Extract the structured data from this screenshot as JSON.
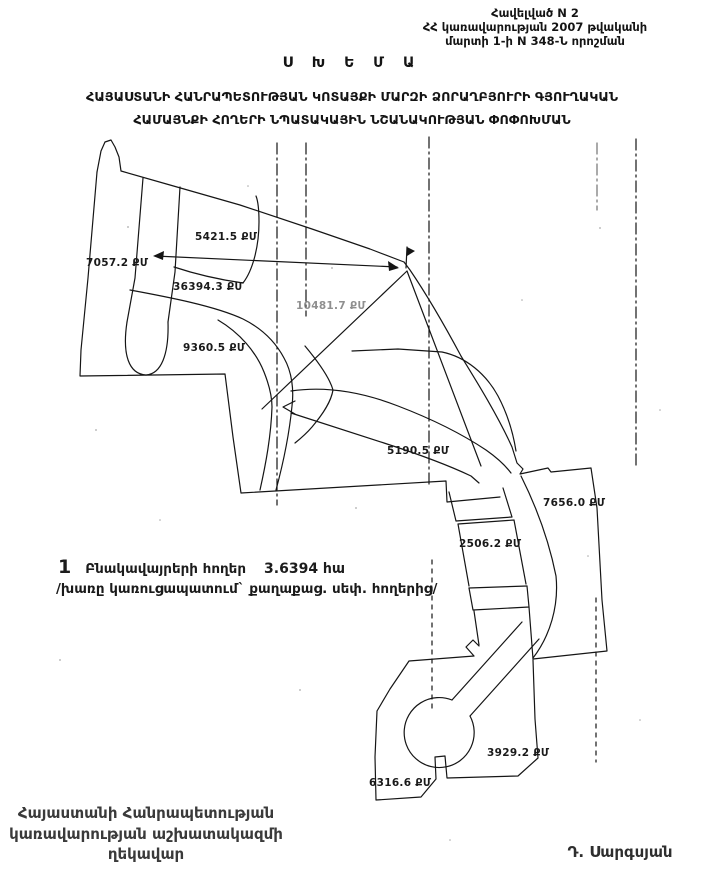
{
  "header": {
    "line1": "Հավելված N 2",
    "line2": "ՀՀ կառավարության 2007 թվականի",
    "line3": "մարտի 1-ի N 348-Ն որոշման"
  },
  "title": "Ս Խ Ե Մ Ա",
  "subtitle": {
    "line1": "ՀԱՅԱՍՏԱՆԻ ՀԱՆՐԱՊԵՏՈՒԹՅԱՆ ԿՈՏԱՅՔԻ ՄԱՐԶԻ ՁՈՐԱՂԲՅՈՒՐԻ ԳՅՈՒՂԱԿԱՆ",
    "line2": "ՀԱՄԱՅՆՔԻ ՀՈՂԵՐԻ ՆՊԱՏԱԿԱՅԻՆ ՆՇԱՆԱԿՈՒԹՅԱՆ ՓՈՓՈԽՄԱՆ"
  },
  "map": {
    "area_labels": [
      {
        "text": "5421.5 ՔՄ",
        "x": 195,
        "y": 231
      },
      {
        "text": "7057.2 ՔՄ",
        "x": 86,
        "y": 257
      },
      {
        "text": "36394.3 ՔՄ",
        "x": 173,
        "y": 281
      },
      {
        "text": "10481.7 ՔՄ",
        "x": 296,
        "y": 300,
        "faded": true
      },
      {
        "text": "9360.5 ՔՄ",
        "x": 183,
        "y": 342
      },
      {
        "text": "5190.5 ՔՄ",
        "x": 387,
        "y": 445
      },
      {
        "text": "7656.0 ՔՄ",
        "x": 543,
        "y": 497
      },
      {
        "text": "2506.2 ՔՄ",
        "x": 459,
        "y": 538
      },
      {
        "text": "3929.2 ՔՄ",
        "x": 487,
        "y": 747
      },
      {
        "text": "6316.6 ՔՄ",
        "x": 369,
        "y": 777
      }
    ]
  },
  "legend": {
    "number": "1",
    "label": "Բնակավայրերի հողեր",
    "value": "3.6394 հա",
    "note": "/խառը կառուցապատում` քաղաքաց. սեփ. հողերից/"
  },
  "footer": {
    "left_line1": "Հայաստանի Հանրապետության",
    "left_line2": "կառավարության աշխատակազմի",
    "left_line3": "ղեկավար",
    "right_signature": "Դ. Սարգսյան"
  },
  "colors": {
    "ink": "#1c1c1c",
    "paper": "#ffffff"
  }
}
